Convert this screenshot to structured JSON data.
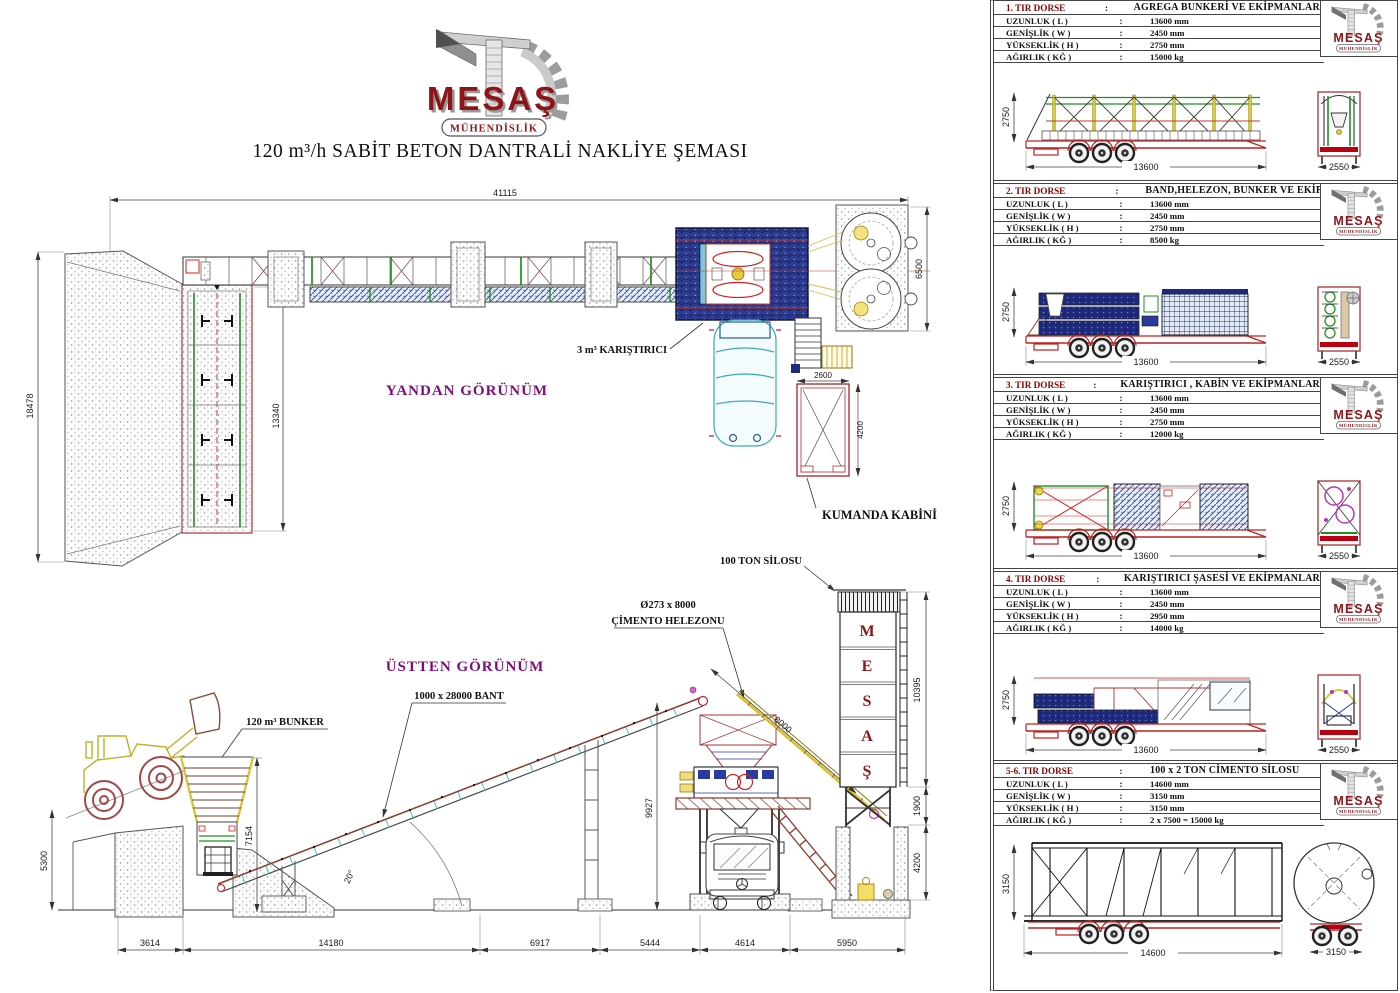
{
  "logo": {
    "name": "MESAŞ",
    "subtitle": "MÜHENDİSLİK"
  },
  "title": "120 m³/h SABİT BETON DANTRALİ NAKLİYE ŞEMASI",
  "main": {
    "view_labels": {
      "upper": "YANDAN GÖRÜNÜM",
      "lower": "ÜSTTEN GÖRÜNÜM"
    },
    "labels": {
      "mixer": "3 m³ KARIŞTIRICI",
      "control_cabin": "KUMANDA KABİNİ",
      "silo": "100 TON SİLOSU",
      "screw_size": "Ø273 x 8000",
      "screw_name": "ÇİMENTO HELEZONU",
      "belt": "1000 x 28000 BANT",
      "bunker": "120 m³ BUNKER",
      "angle": "20°"
    },
    "silo_letters": [
      "M",
      "E",
      "S",
      "A",
      "Ş"
    ],
    "dims": {
      "total_length": "41115",
      "stock_depth": "18478",
      "bunker_length": "13340",
      "silo_block_width": "6500",
      "cabin_width": "2600",
      "cabin_length": "4200",
      "wall_height": "5300",
      "bunker_height": "7154",
      "tower_height": "9927",
      "screw_length": "8000",
      "silo_height": "10395",
      "silo_legs": "1900",
      "pit_depth": "4200",
      "bottom": [
        "3614",
        "14180",
        "6917",
        "5444",
        "4614",
        "5950"
      ]
    }
  },
  "spec_rows": [
    "UZUNLUK ( L )",
    "GENİŞLİK ( W )",
    "YÜKSEKLİK ( H )",
    "AĞIRLIK ( KĞ )"
  ],
  "colon": ":",
  "panels": [
    {
      "no": "1. TIR DORSE",
      "content": "AGREGA BUNKERİ VE EKİPMANLARI",
      "length": "13600 mm",
      "width": "2450 mm",
      "height": "2750 mm",
      "weight": "15000 kg",
      "dims": {
        "h": "2750",
        "l": "13600",
        "w": "2550"
      }
    },
    {
      "no": "2. TIR DORSE",
      "content": "BAND,HELEZON, BUNKER VE EKİP.",
      "length": "13600 mm",
      "width": "2450 mm",
      "height": "2750 mm",
      "weight": "8500 kg",
      "dims": {
        "h": "2750",
        "l": "13600",
        "w": "2550"
      }
    },
    {
      "no": "3. TIR DORSE",
      "content": "KARIŞTIRICI , KABİN VE EKİPMANLARI",
      "length": "13600 mm",
      "width": "2450 mm",
      "height": "2750 mm",
      "weight": "12000 kg",
      "dims": {
        "h": "2750",
        "l": "13600",
        "w": "2550"
      }
    },
    {
      "no": "4. TIR DORSE",
      "content": "KARIŞTIRICI ŞASESİ VE EKİPMANLARI",
      "length": "13600 mm",
      "width": "2450 mm",
      "height": "2950 mm",
      "weight": "14000 kg",
      "dims": {
        "h": "2750",
        "l": "13600",
        "w": "2550"
      }
    },
    {
      "no": "5-6. TIR DORSE",
      "content": "100 x 2 TON CİMENTO SİLOSU",
      "length": "14600 mm",
      "width": "3150 mm",
      "height": "3150 mm",
      "weight": "2 x 7500 = 15000 kg",
      "dims": {
        "h": "3150",
        "l": "14600",
        "w": "3150"
      }
    }
  ]
}
